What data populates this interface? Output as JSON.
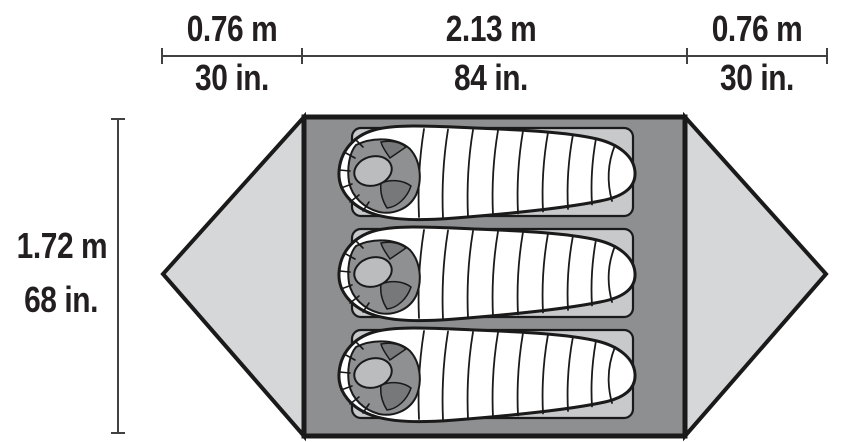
{
  "diagram": {
    "kind": "tent-floorplan-top-view",
    "sleeper_count": 3
  },
  "dimensions": {
    "top_segments": [
      {
        "meters": "0.76 m",
        "inches": "30 in."
      },
      {
        "meters": "2.13 m",
        "inches": "84 in."
      },
      {
        "meters": "0.76 m",
        "inches": "30 in."
      }
    ],
    "left": {
      "meters": "1.72 m",
      "inches": "68 in."
    }
  },
  "colors": {
    "ink": "#1a1a1a",
    "floor": "#8e8f91",
    "vestibule": "#d6d7d8",
    "pad": "#c8c9cb",
    "bag": "#ffffff",
    "hood": "#8f9092",
    "hood_shadow": "#77787a",
    "hood_face": "#bbbcbe",
    "dim_line": "#414042",
    "text": "#231f20"
  }
}
